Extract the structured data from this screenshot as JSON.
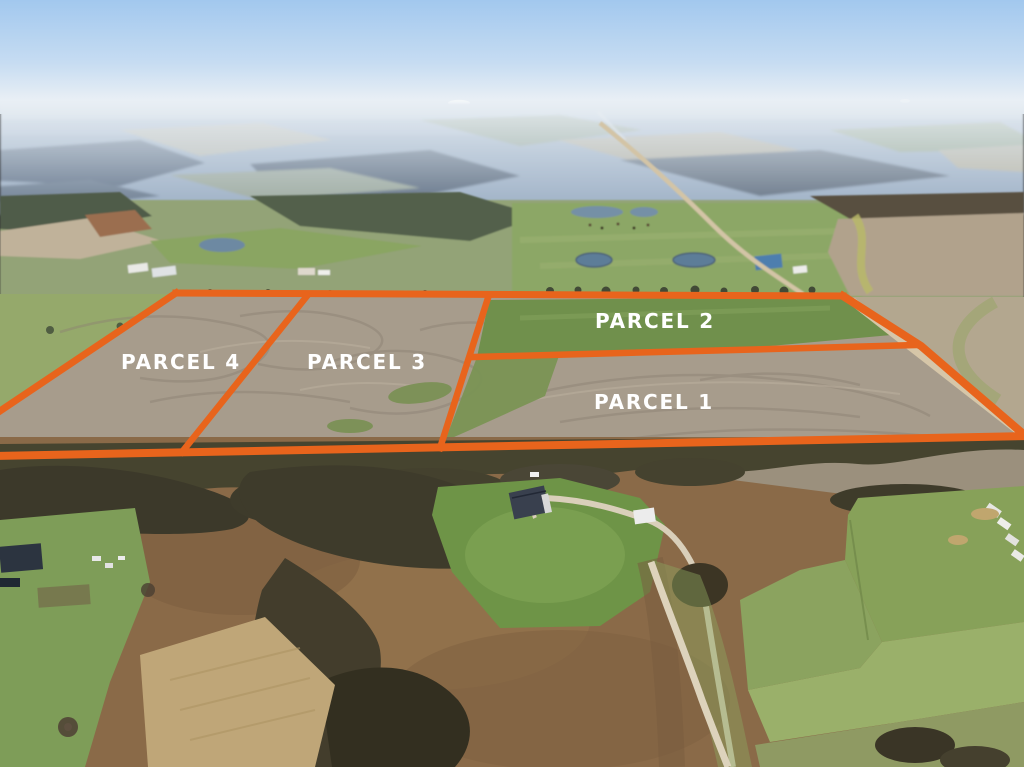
{
  "overlay": {
    "accent_color": "#e8641c",
    "label_color": "#ffffff",
    "parcels": [
      {
        "label": "PARCEL 4",
        "label_x": 181,
        "label_y": 369
      },
      {
        "label": "PARCEL 3",
        "label_x": 367,
        "label_y": 369
      },
      {
        "label": "PARCEL 2",
        "label_x": 655,
        "label_y": 328
      },
      {
        "label": "PARCEL 1",
        "label_x": 654,
        "label_y": 409
      }
    ],
    "boundary_lines": [
      {
        "name": "outer-top",
        "points": [
          [
            176,
            293
          ],
          [
            843,
            296
          ]
        ],
        "width": 7
      },
      {
        "name": "outer-right",
        "points": [
          [
            843,
            296
          ],
          [
            921,
            346
          ],
          [
            1028,
            438
          ]
        ],
        "width": 8
      },
      {
        "name": "outer-bottom",
        "points": [
          [
            -6,
            456
          ],
          [
            1028,
            436
          ]
        ],
        "width": 8
      },
      {
        "name": "outer-left",
        "points": [
          [
            176,
            293
          ],
          [
            -6,
            415
          ]
        ],
        "width": 7
      },
      {
        "name": "divider-4-3",
        "points": [
          [
            307,
            296
          ],
          [
            182,
            452
          ]
        ],
        "width": 6.5
      },
      {
        "name": "divider-3-east",
        "points": [
          [
            488,
            298
          ],
          [
            440,
            448
          ]
        ],
        "width": 6.5
      },
      {
        "name": "divider-1-2",
        "points": [
          [
            474,
            357
          ],
          [
            918,
            345
          ]
        ],
        "width": 6.5
      }
    ]
  }
}
